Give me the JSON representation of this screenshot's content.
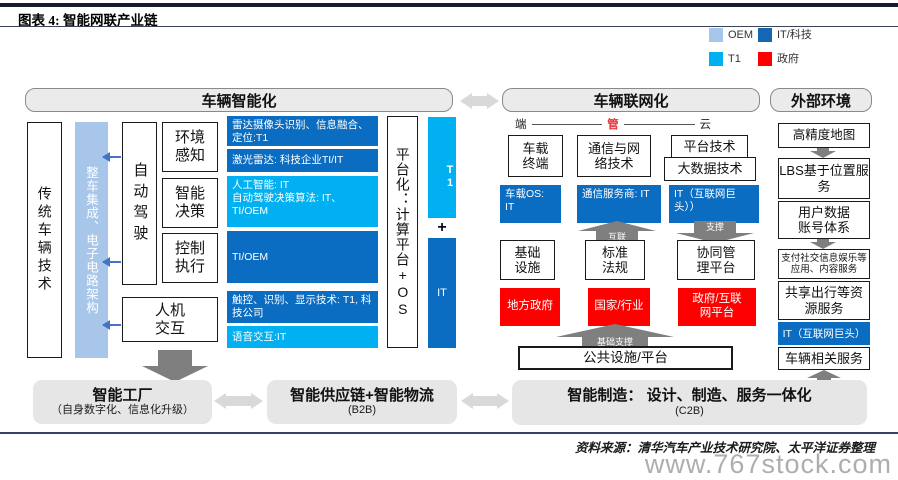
{
  "title": "图表 4: 智能网联产业链",
  "legend": {
    "items": [
      {
        "label": "OEM",
        "color": "#A8C6E9"
      },
      {
        "label": "IT/科技",
        "color": "#1467B0"
      },
      {
        "label": "T1",
        "color": "#00B0F0"
      },
      {
        "label": "政府",
        "color": "#FF0000"
      }
    ]
  },
  "smart": {
    "header": "车辆智能化",
    "traditional": "传统车辆技术",
    "integration": "整车集成、电子电路架构",
    "autodrive": "自动驾驶",
    "perception": "环境感知",
    "decision": "智能决策",
    "control": "控制执行",
    "hmi": "人机交互",
    "tech_radar": "雷达摄像头识别、信息融合、定位:T1",
    "tech_lidar": "激光雷达: 科技企业TI/IT",
    "tech_ai_l1": "人工智能: IT",
    "tech_ai_l2": "自动驾驶决策算法: IT、TI/OEM",
    "tech_ctrl": "TI/OEM",
    "tech_touch": "触控、识别、显示技术: T1, 科技公司",
    "tech_voice": "语音交互:IT",
    "platform": "平台化：计算平台+OS",
    "t1": "T1",
    "plus": "+",
    "it": "IT"
  },
  "network": {
    "header": "车辆联网化",
    "pipe": {
      "duan": "端",
      "guan": "管",
      "yun": "云"
    },
    "terminal": "车载终端",
    "os": "车载OS: IT",
    "comm": "通信与网络技术",
    "carrier": "通信服务商: IT",
    "platform_tech": "平台技术",
    "bigdata": "大数据技术",
    "it_giant": "IT（互联网巨头））",
    "arrow_interlink": "互联",
    "arrow_support": "支撑",
    "infra": "基础设施",
    "standard": "标准法规",
    "coop": "协同管理平台",
    "local_gov": "地方政府",
    "national": "国家/行业",
    "gov_platform": "政府/互联网平台",
    "arrow_base": "基础支撑",
    "public": "公共设施/平台"
  },
  "external": {
    "header": "外部环境",
    "map": "高精度地图",
    "lbs": "LBS基于位置服务",
    "account": "用户数据账号体系",
    "content": "支付社交信息娱乐等应用、内容服务",
    "sharing": "共享出行等资源服务",
    "it_giant": "IT（互联网巨头）",
    "service": "车辆相关服务"
  },
  "bottom": {
    "factory": {
      "title": "智能工厂",
      "sub": "（自身数字化、信息化升级）"
    },
    "supply": {
      "title": "智能供应链+智能物流",
      "sub": "(B2B)"
    },
    "manufacture": {
      "title": "智能制造：  设计、制造、服务一体化",
      "sub": "(C2B)"
    }
  },
  "footer": {
    "source": "资料来源：清华汽车产业技术研究院、太平洋证券整理",
    "watermark": "www.767stock.com"
  },
  "colors": {
    "oem_blue": "#A8C6E9",
    "it_dark_blue": "#0B6DC2",
    "t1_cyan": "#00B0F0",
    "gov_red": "#FF0000",
    "gray_arrow": "#7F7F7F",
    "light_arrow": "#D9D9D9",
    "navy_rule": "#36406B"
  }
}
